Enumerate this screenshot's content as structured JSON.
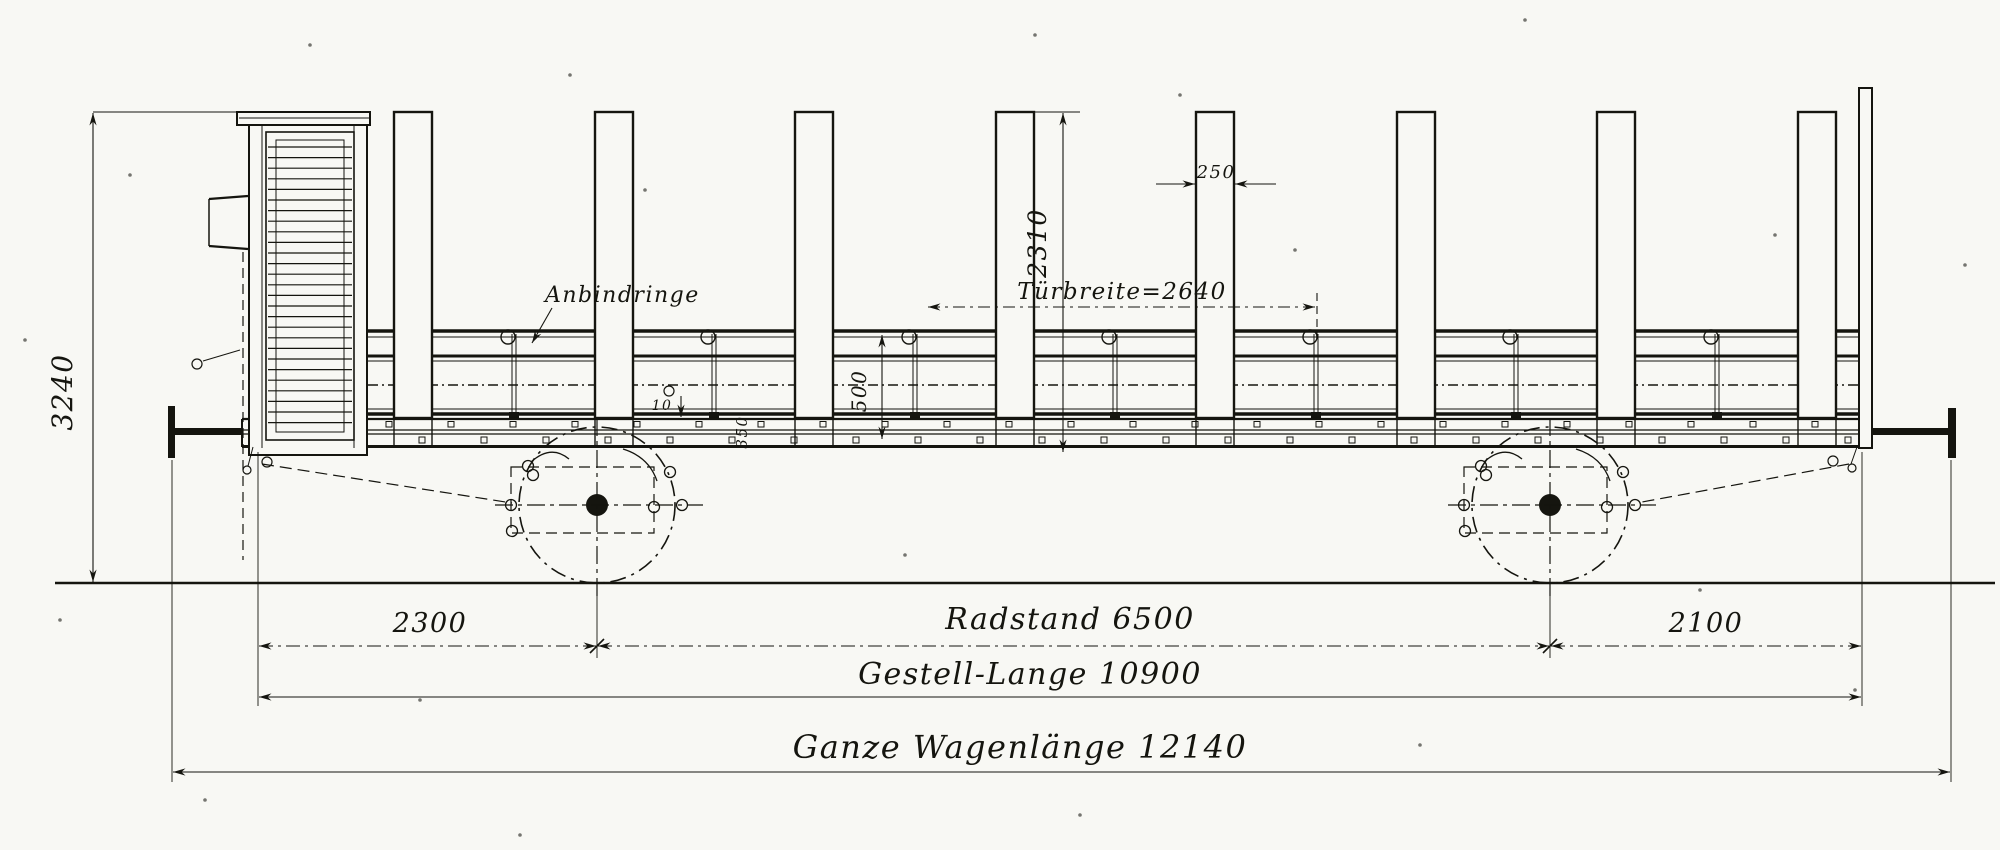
{
  "drawing": {
    "subject": "railway stake wagon side elevation",
    "dimensions": {
      "total_height": "3240",
      "stake_width": "250",
      "stake_height": "2310",
      "door_width": "Türbreite=2640",
      "side_height": "500",
      "ring_offset": "10",
      "frame_depth": "350",
      "left_overhang": "2300",
      "wheelbase": "Radstand 6500",
      "right_overhang": "2100",
      "frame_length": "Gestell-Lange 10900",
      "total_length": "Ganze Wagenlänge 12140"
    },
    "annotations": {
      "tie_rings": "Anbindringe"
    }
  }
}
